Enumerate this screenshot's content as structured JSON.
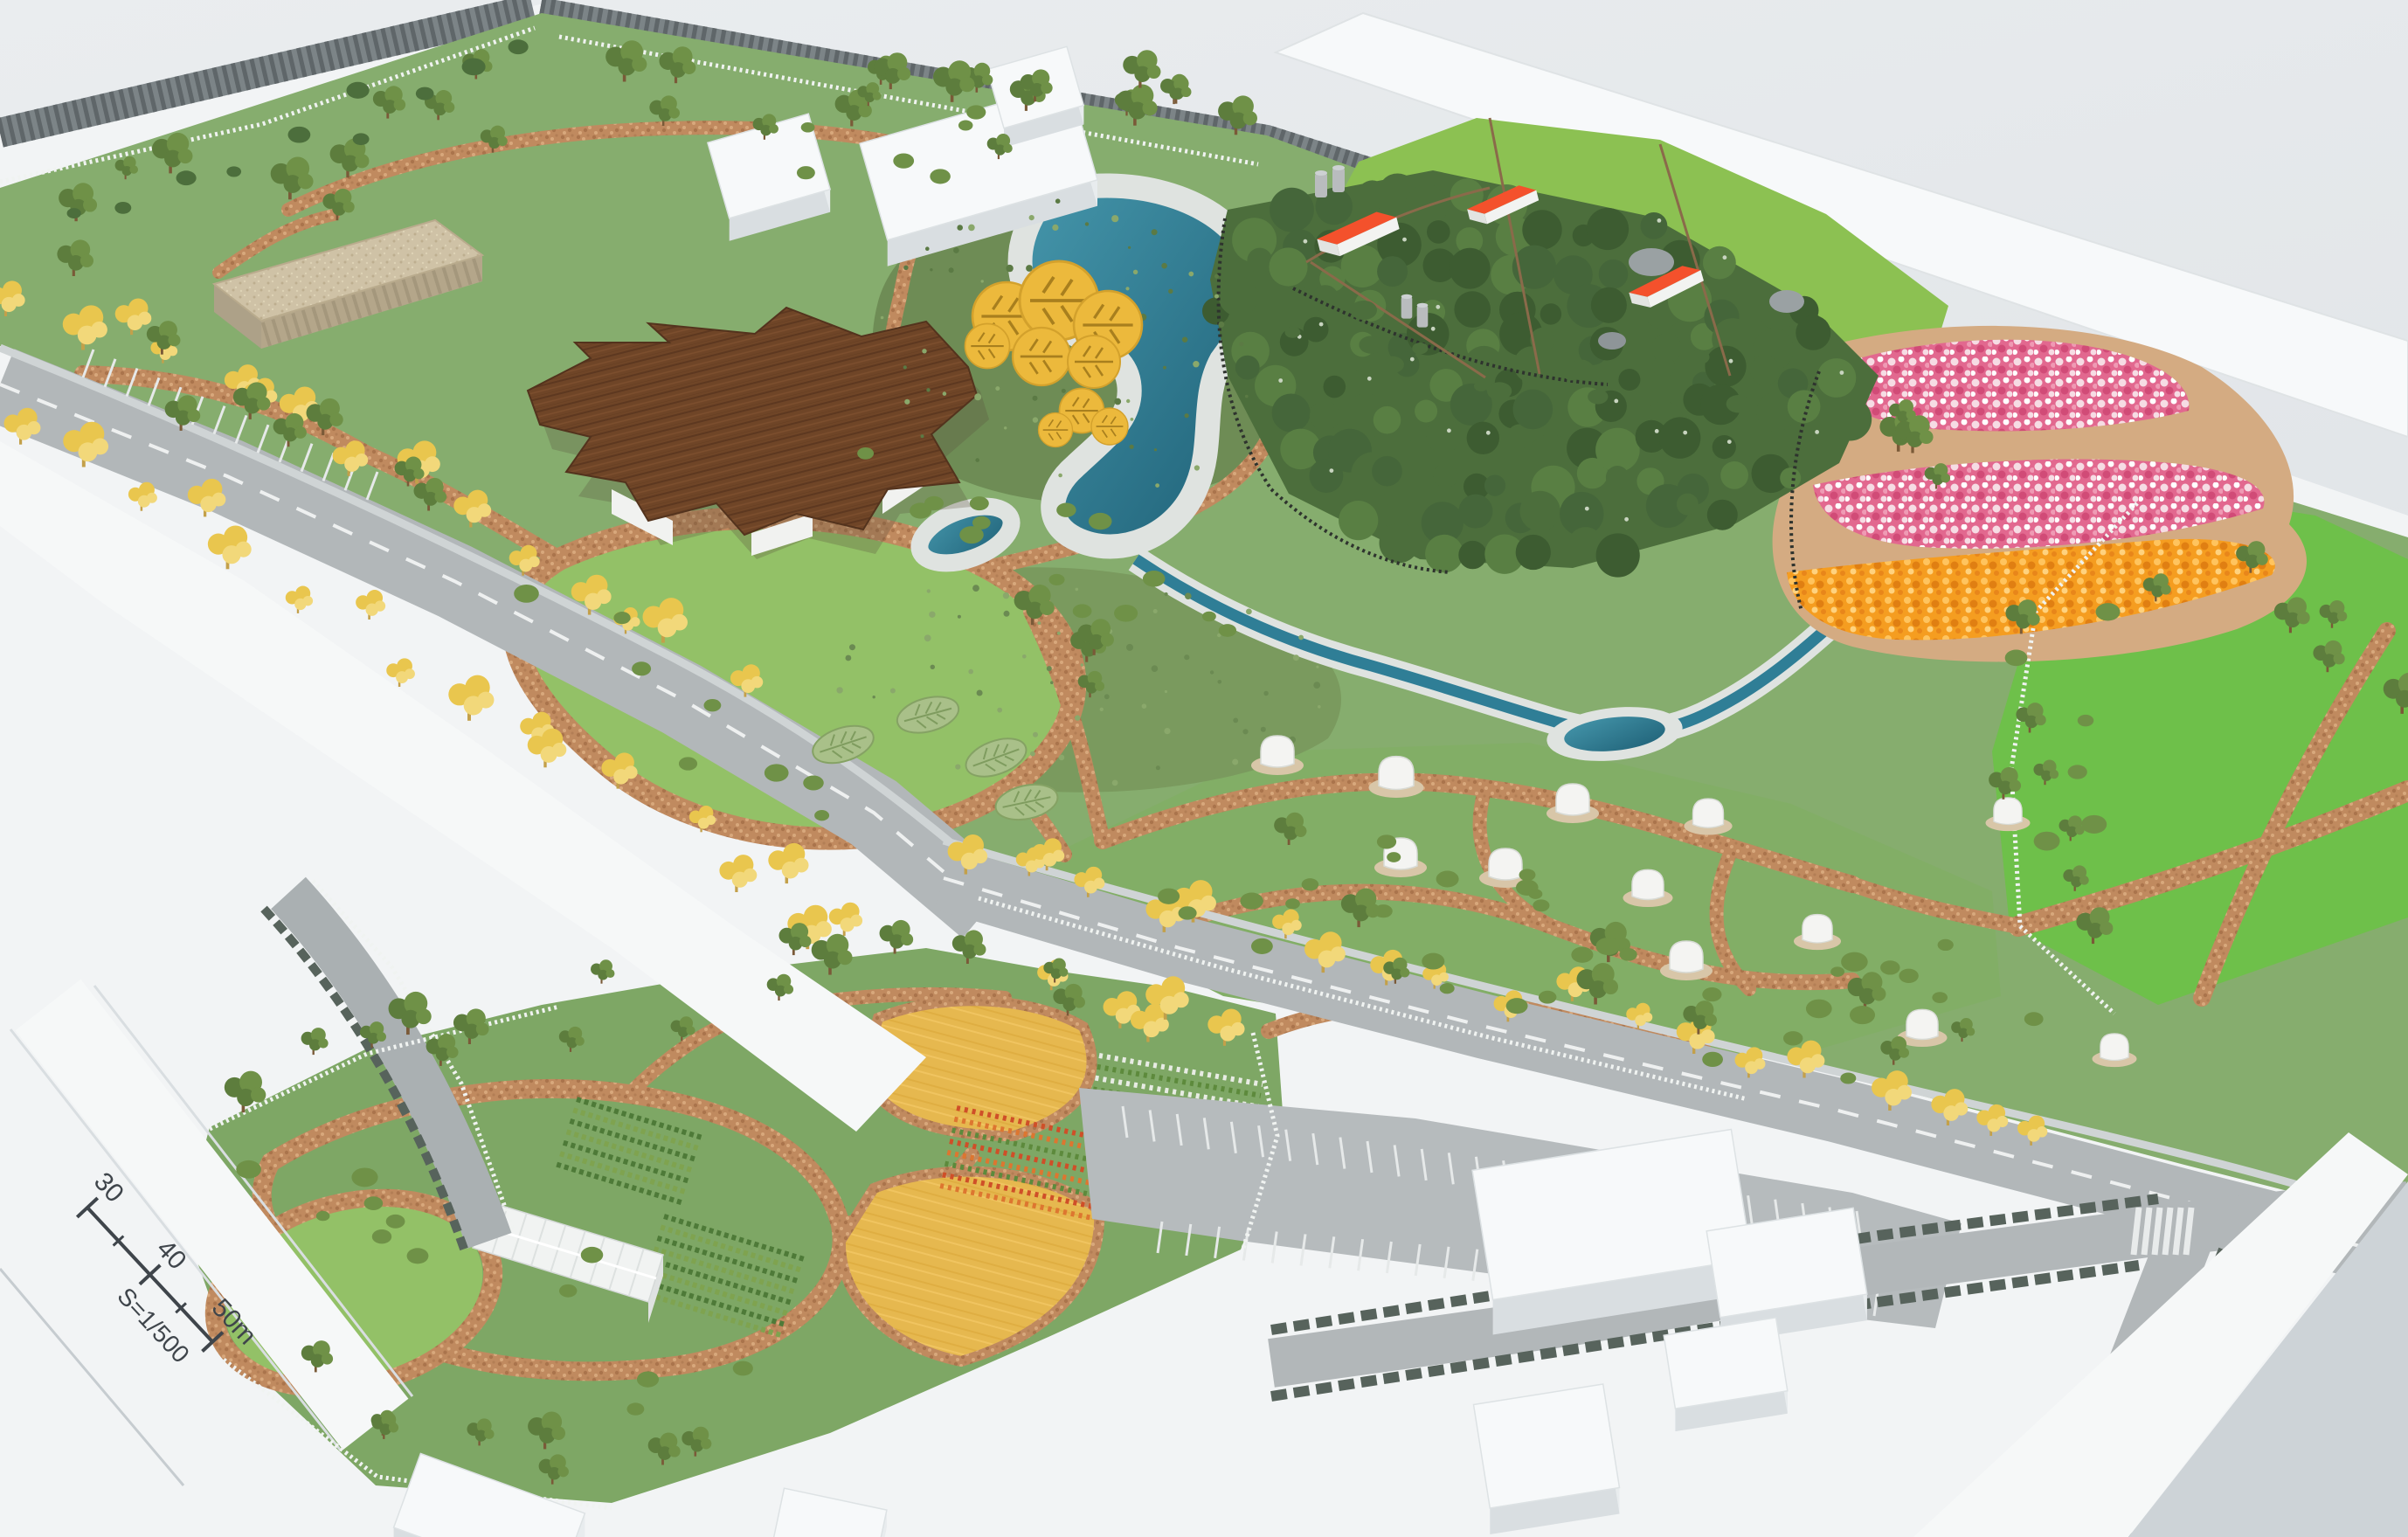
{
  "scale_bar": {
    "tick_30": "30",
    "tick_40": "40",
    "tick_50": "50m",
    "scale_label": "S=1/500"
  },
  "features": [
    "architectural scale model of a park masterplan",
    "white context buildings",
    "railway corridor",
    "tree-lined avenue with yellow blossom trees",
    "parking lots",
    "flat-roof beige building",
    "wooden star-shaped pavilion",
    "yellow flower canopies",
    "pond with gravel edge",
    "wetland stream",
    "dense woodland",
    "farmstead with orange roofs and silos",
    "pink and white flower fields",
    "orange flower field",
    "great lawn",
    "meadow with white dome pavilions",
    "leaf-shaped canopies",
    "community gardens with greenhouse",
    "crop rows",
    "white lattice fences",
    "scale bar"
  ],
  "palette": {
    "table": "#e7eaec",
    "table2": "#dde1e5",
    "base": "#f2f4f5",
    "slab": "#f7f9fa",
    "park": "#86ad6e",
    "park2": "#7ea765",
    "lawn": "#6ec04a",
    "pasture": "#8cc152",
    "meadow": "#82ae66",
    "circle_lawn": "#93c167",
    "forest1": "#3d5c31",
    "forest2": "#4c6e3c",
    "forest3": "#597f43",
    "wet": "#6e8c55",
    "wet2": "#7a9a5e",
    "path": "#c08a5f",
    "path2": "#d4ab82",
    "water1": "#4596ab",
    "water2": "#1f6177",
    "gravel": "#dfe3e0",
    "road": "#b2b7b9",
    "road_dark": "#7c8487",
    "ribs": "#5f6669",
    "mark": "#eef0f0",
    "wood": "#6f4527",
    "wood2": "#5d3820",
    "beige": "#cfc2a6",
    "beige2": "#b4a68a",
    "roof": "#f4512c",
    "dome": "#f4f4f2",
    "dome_base": "#d8c6a8",
    "pink": "#e2688f",
    "pink2": "#f6dce4",
    "pink3": "#d14b77",
    "orangef": "#f59d20",
    "orangef2": "#e07f12",
    "ytree": "#e9c64e",
    "yfield": "#e6b84f",
    "canopy": "#ecb93c",
    "leafc": "#a9c089",
    "tree1": "#5d7d3d",
    "tree2": "#6f9147",
    "bush": "#6f9147",
    "hedge": "#57635c",
    "fence": "#f0f3f1",
    "mesh": "#2e332e",
    "silo": "#b9bcbe",
    "glass": "#f1f3f2",
    "ink": "#3f454b",
    "white": "#f6f8f8",
    "shadowc": "#c9ced2"
  }
}
